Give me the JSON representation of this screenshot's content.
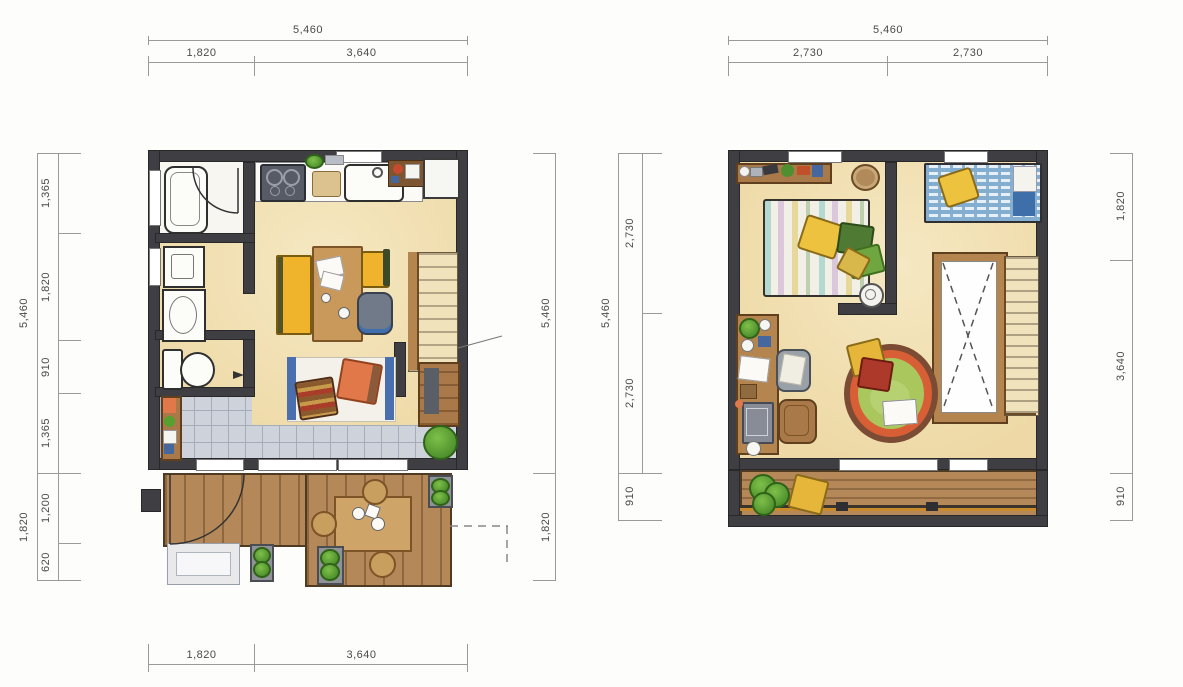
{
  "left_plan": {
    "dim_top": {
      "total": "5,460",
      "segments": [
        "1,820",
        "3,640"
      ]
    },
    "dim_bottom": {
      "segments": [
        "1,820",
        "3,640"
      ]
    },
    "dim_left": {
      "total": "5,460",
      "segments": [
        "1,365",
        "1,820",
        "910",
        "1,365"
      ],
      "lower_total": "1,820",
      "lower_segments": [
        "1,200",
        "620"
      ]
    },
    "dim_right": {
      "total": "5,460",
      "lower": "1,820"
    }
  },
  "right_plan": {
    "dim_top": {
      "total": "5,460",
      "segments": [
        "2,730",
        "2,730"
      ]
    },
    "dim_left": {
      "total": "5,460",
      "segments": [
        "2,730",
        "2,730"
      ],
      "below": "910"
    },
    "dim_right": {
      "segments": [
        "1,820",
        "3,640",
        "910"
      ]
    }
  },
  "palette": {
    "wall": "#3f3f43",
    "floor": "#f1dfae",
    "tile_floor": "#ced3db",
    "wood_deck": "#b5885a",
    "wood_furniture": "#c9995c",
    "accent_yellow": "#eeb945",
    "accent_orange": "#e0784a",
    "accent_blue": "#4a7fb0",
    "accent_green": "#67a43c",
    "rug_green": "#aac75e",
    "rug_ring_orange": "#d85f35",
    "dim_line": "#9a9a9a",
    "dim_text": "#4a4a4a"
  }
}
